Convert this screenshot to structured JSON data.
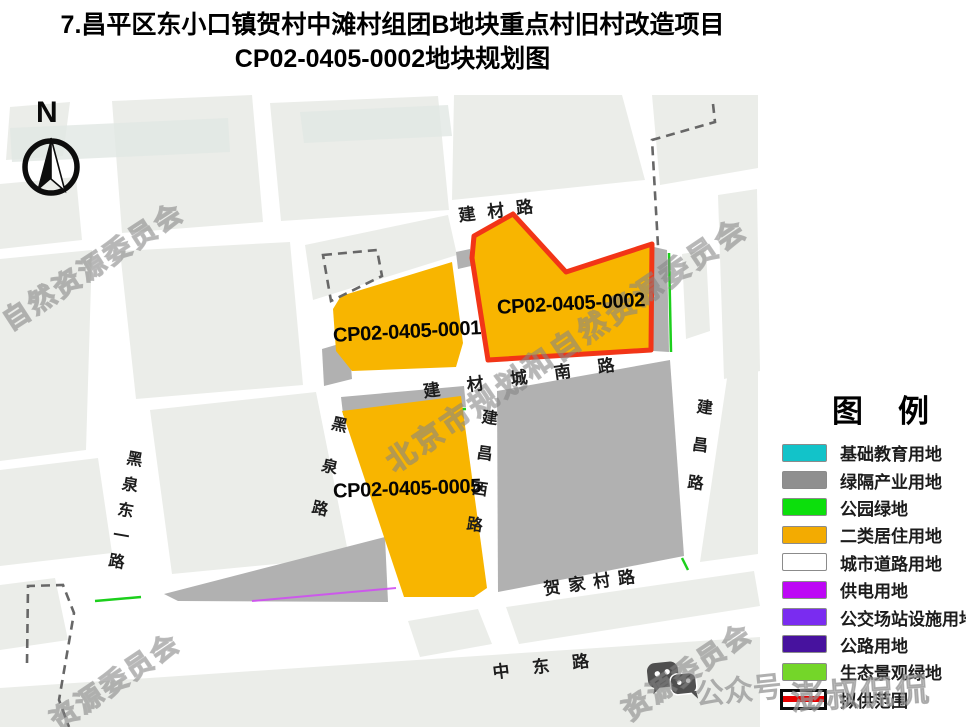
{
  "title": {
    "line1": "7.昌平区东小口镇贺村中滩村组团B地块重点村旧村改造项目",
    "line2": "CP02-0405-0002地块规划图"
  },
  "compass": {
    "north_label": "N"
  },
  "parcels": {
    "p1": {
      "label": "CP02-0405-0001"
    },
    "p2": {
      "label": "CP02-0405-0002",
      "outline_color": "#f23517"
    },
    "p5": {
      "label": "CP02-0405-0005"
    }
  },
  "roads": {
    "jiancai": "建材路",
    "jiancai_chengnan": "建材城南路",
    "heiquan": "黑泉路",
    "heiquan_dongyi": "黑泉东一路",
    "jianchang_xi": "建昌西路",
    "jianchang": "建昌路",
    "hejiacun": "贺家村路",
    "zhongdong": "中东路"
  },
  "legend": {
    "title": "图　例",
    "items": [
      {
        "label": "基础教育用地",
        "color": "#12c3c9"
      },
      {
        "label": "绿隔产业用地",
        "color": "#8f8f8f"
      },
      {
        "label": "公园绿地",
        "color": "#0cdf0c"
      },
      {
        "label": "二类居住用地",
        "color": "#f3ab01"
      },
      {
        "label": "城市道路用地",
        "color": "#ffffff"
      },
      {
        "label": "供电用地",
        "color": "#bd07f5"
      },
      {
        "label": "公交场站设施用地",
        "color": "#7a2cf0"
      },
      {
        "label": "公路用地",
        "color": "#47129e"
      },
      {
        "label": "生态景观绿地",
        "color": "#74d629"
      }
    ],
    "scope_item": {
      "label": "拟供范围",
      "line_color": "#e60000"
    }
  },
  "watermarks": {
    "w1": "自然资源委员会",
    "w2": "北京市规划和自然资源委员会",
    "w3": "资源委员会",
    "w4": "资源委员会",
    "w5": "澎叔侃侃",
    "wechat_label": "公众号"
  },
  "map_colors": {
    "block": "#ebede9",
    "industry_gray": "#b1b1b1",
    "residential_orange": "#f8b500",
    "scope_red": "#f23517",
    "eco_green": "#1ccf1c",
    "power_magenta": "#cf4ff2"
  }
}
